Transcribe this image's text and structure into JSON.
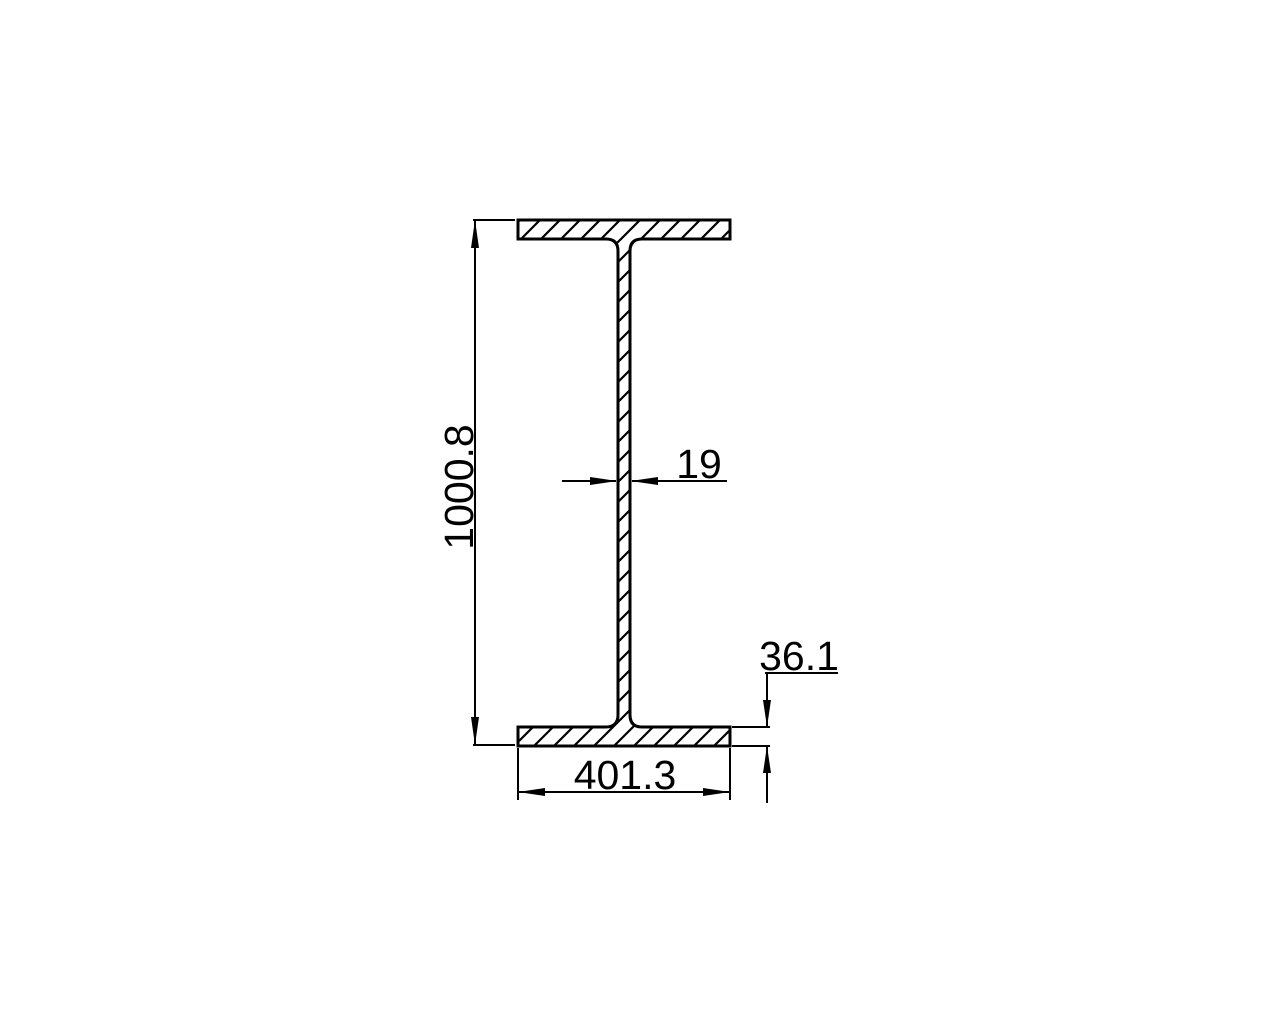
{
  "drawing": {
    "type": "I-beam cross-section, CAD dimensioned drawing",
    "colors": {
      "background": "#ffffff",
      "line": "#000000"
    },
    "dimensions": {
      "overall_height": "1000.8",
      "web_thickness": "19",
      "flange_thickness": "36.1",
      "flange_width": "401.3"
    }
  }
}
